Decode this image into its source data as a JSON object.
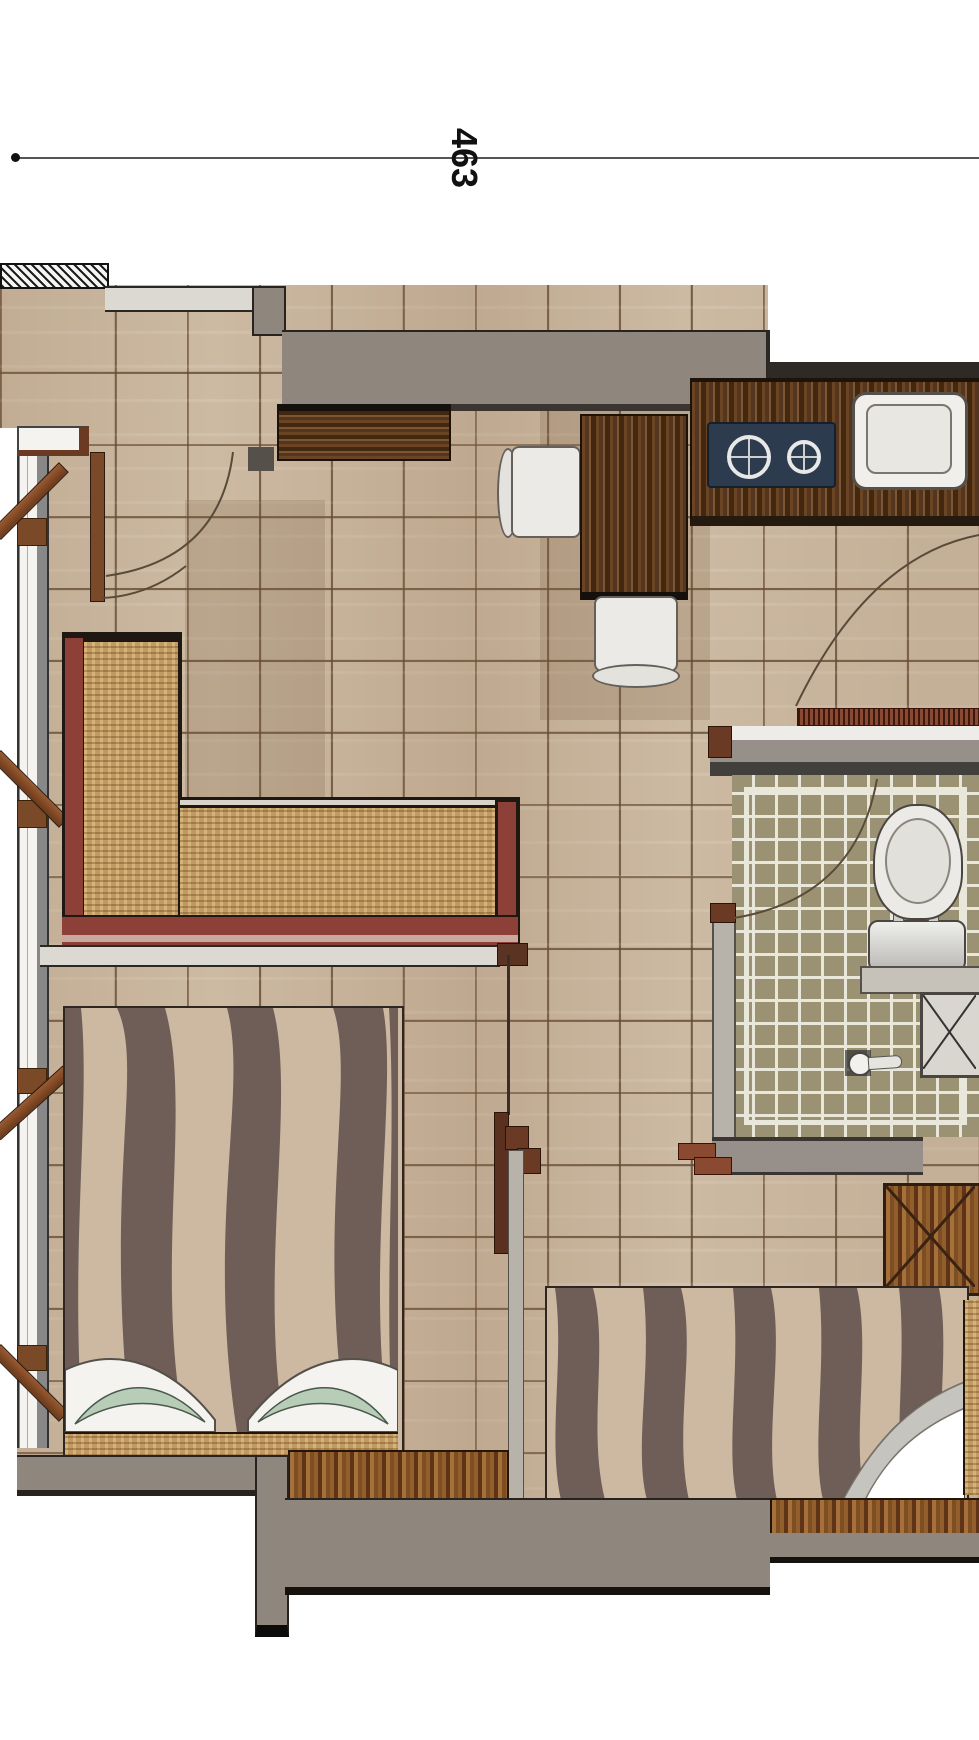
{
  "title": "apartment-unit-floor-plan",
  "dimension": {
    "label": "463"
  },
  "rooms": [
    {
      "name": "living-dining",
      "floor": "beige-ceramic-tile"
    },
    {
      "name": "kitchen",
      "floor": "beige-ceramic-tile"
    },
    {
      "name": "bathroom",
      "floor": "olive-mosaic-tile"
    },
    {
      "name": "bedroom-1",
      "floor": "beige-ceramic-tile"
    },
    {
      "name": "bedroom-2",
      "floor": "beige-ceramic-tile"
    }
  ],
  "furniture": [
    "l-shaped-wicker-sofa",
    "dining-table",
    "dining-chair-left",
    "dining-chair-bottom",
    "kitchen-counter",
    "two-burner-cooktop",
    "kitchen-sink",
    "entry-console",
    "toilet",
    "vanity-counter",
    "service-shaft",
    "shower-mixer",
    "double-bed-1",
    "double-bed-2",
    "wardrobe-x-cabinet",
    "low-cabinet-bedroom-1",
    "low-cabinet-bedroom-2",
    "casement-windows",
    "swing-doors"
  ],
  "colors": {
    "floor_tile": "#cdbaa3",
    "tile_grout": "#60462e",
    "wall_gray": "#8f877e",
    "wood_dark": "#54351f",
    "wood_medium": "#8a5226",
    "sofa_frame_maroon": "#8c4038",
    "wicker": "#c09a62",
    "cooktop_navy": "#2c3c4e",
    "bath_tile_olive": "#9b9273",
    "bath_grout": "#e9e6da",
    "zebra_dark": "#6f5e58",
    "zebra_light": "#cdb9a2",
    "pillow_mint": "#b7cdb8",
    "section_hatch_red": "#8a4a32"
  }
}
